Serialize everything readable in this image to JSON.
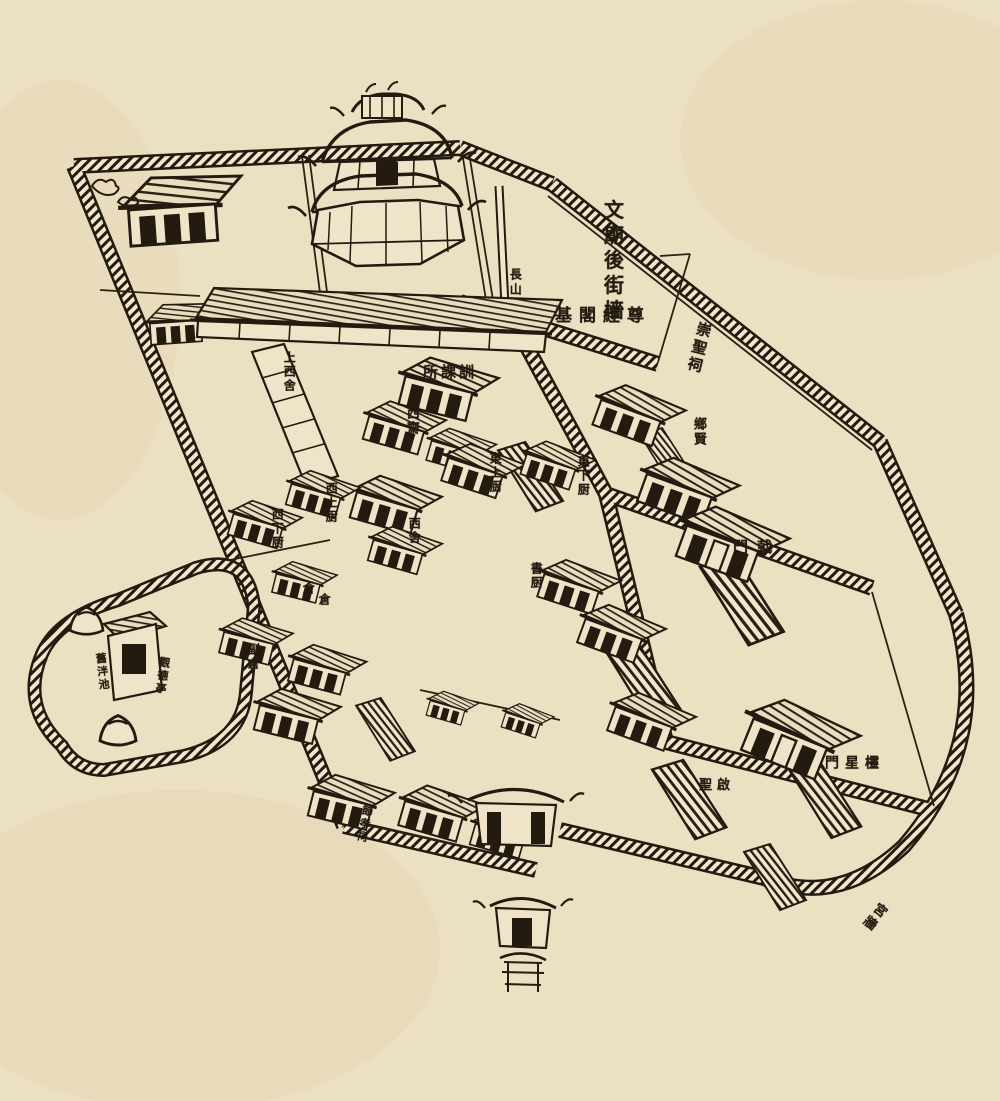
{
  "artwork": {
    "kind": "woodblock temple-school map",
    "palette": {
      "paper": "#ece0c3",
      "ink": "#241b10",
      "paper_light": "#f1e7cc"
    },
    "labels": [
      {
        "id": "wenmiao-houjieqiang",
        "text": "文廟後街墻",
        "mode": "v",
        "x": 612,
        "y": 262,
        "size": 20,
        "spacing": 5
      },
      {
        "id": "changshan",
        "text": "長山",
        "mode": "v",
        "x": 515,
        "y": 283,
        "size": 12,
        "spacing": 3
      },
      {
        "id": "zunjinggeji",
        "text": "尊經閣基",
        "mode": "h",
        "rtl": true,
        "x": 603,
        "y": 317,
        "size": 17,
        "spacing": 7
      },
      {
        "id": "chongshengci",
        "text": "崇聖祠",
        "mode": "v",
        "x": 698,
        "y": 348,
        "size": 15,
        "spacing": 3,
        "rotate": 14
      },
      {
        "id": "xunkesuo",
        "text": "訓課所",
        "mode": "h",
        "rtl": true,
        "x": 450,
        "y": 373,
        "size": 15,
        "spacing": 3
      },
      {
        "id": "shangxishe",
        "text": "上西舍",
        "mode": "v",
        "x": 289,
        "y": 372,
        "size": 12,
        "spacing": 2
      },
      {
        "id": "xizhai",
        "text": "西齋",
        "mode": "v",
        "x": 411,
        "y": 421,
        "size": 13,
        "spacing": 2
      },
      {
        "id": "xiangxian",
        "text": "鄉賢",
        "mode": "v",
        "x": 698,
        "y": 432,
        "size": 13,
        "spacing": 2
      },
      {
        "id": "dongshangchu",
        "text": "東上厨",
        "mode": "v",
        "x": 495,
        "y": 473,
        "size": 12,
        "spacing": 2
      },
      {
        "id": "dongxiachu",
        "text": "東下厨",
        "mode": "v",
        "x": 583,
        "y": 476,
        "size": 12,
        "spacing": 2
      },
      {
        "id": "xishangchu",
        "text": "西上厨",
        "mode": "v",
        "x": 331,
        "y": 503,
        "size": 12,
        "spacing": 2
      },
      {
        "id": "xixiachu",
        "text": "西下厨",
        "mode": "v",
        "x": 277,
        "y": 529,
        "size": 12,
        "spacing": 2
      },
      {
        "id": "xishe",
        "text": "西舍",
        "mode": "v",
        "x": 414,
        "y": 531,
        "size": 12,
        "spacing": 2
      },
      {
        "id": "jimen",
        "text": "戟門",
        "mode": "h",
        "rtl": true,
        "x": 757,
        "y": 548,
        "size": 15,
        "spacing": 9
      },
      {
        "id": "shuchu",
        "text": "書厨",
        "mode": "v",
        "x": 536,
        "y": 576,
        "size": 12,
        "spacing": 2
      },
      {
        "id": "cang-1",
        "text": "倉",
        "mode": "v",
        "x": 308,
        "y": 588,
        "size": 12
      },
      {
        "id": "cang-2",
        "text": "倉",
        "mode": "v",
        "x": 324,
        "y": 599,
        "size": 12
      },
      {
        "id": "fucang",
        "text": "副倉",
        "mode": "v",
        "x": 253,
        "y": 657,
        "size": 12,
        "spacing": 2
      },
      {
        "id": "jiupanchi",
        "text": "舊泮池",
        "mode": "v",
        "x": 102,
        "y": 672,
        "size": 11,
        "spacing": 2,
        "rotate": -6
      },
      {
        "id": "guandeting",
        "text": "觀德亭",
        "mode": "v",
        "x": 162,
        "y": 676,
        "size": 11,
        "spacing": 2,
        "rotate": 8
      },
      {
        "id": "qisheng",
        "text": "啟聖",
        "mode": "h",
        "rtl": true,
        "x": 717,
        "y": 786,
        "size": 13,
        "spacing": 5
      },
      {
        "id": "lingxingmen",
        "text": "欞星門",
        "mode": "h",
        "rtl": true,
        "x": 855,
        "y": 764,
        "size": 14,
        "spacing": 6
      },
      {
        "id": "jiexiaoci",
        "text": "節孝祠",
        "mode": "v",
        "x": 364,
        "y": 824,
        "size": 11,
        "spacing": 2,
        "rotate": 12
      },
      {
        "id": "gongqiang",
        "text": "宮牆",
        "mode": "v",
        "x": 873,
        "y": 916,
        "size": 13,
        "spacing": 3,
        "rotate": 38
      }
    ]
  }
}
